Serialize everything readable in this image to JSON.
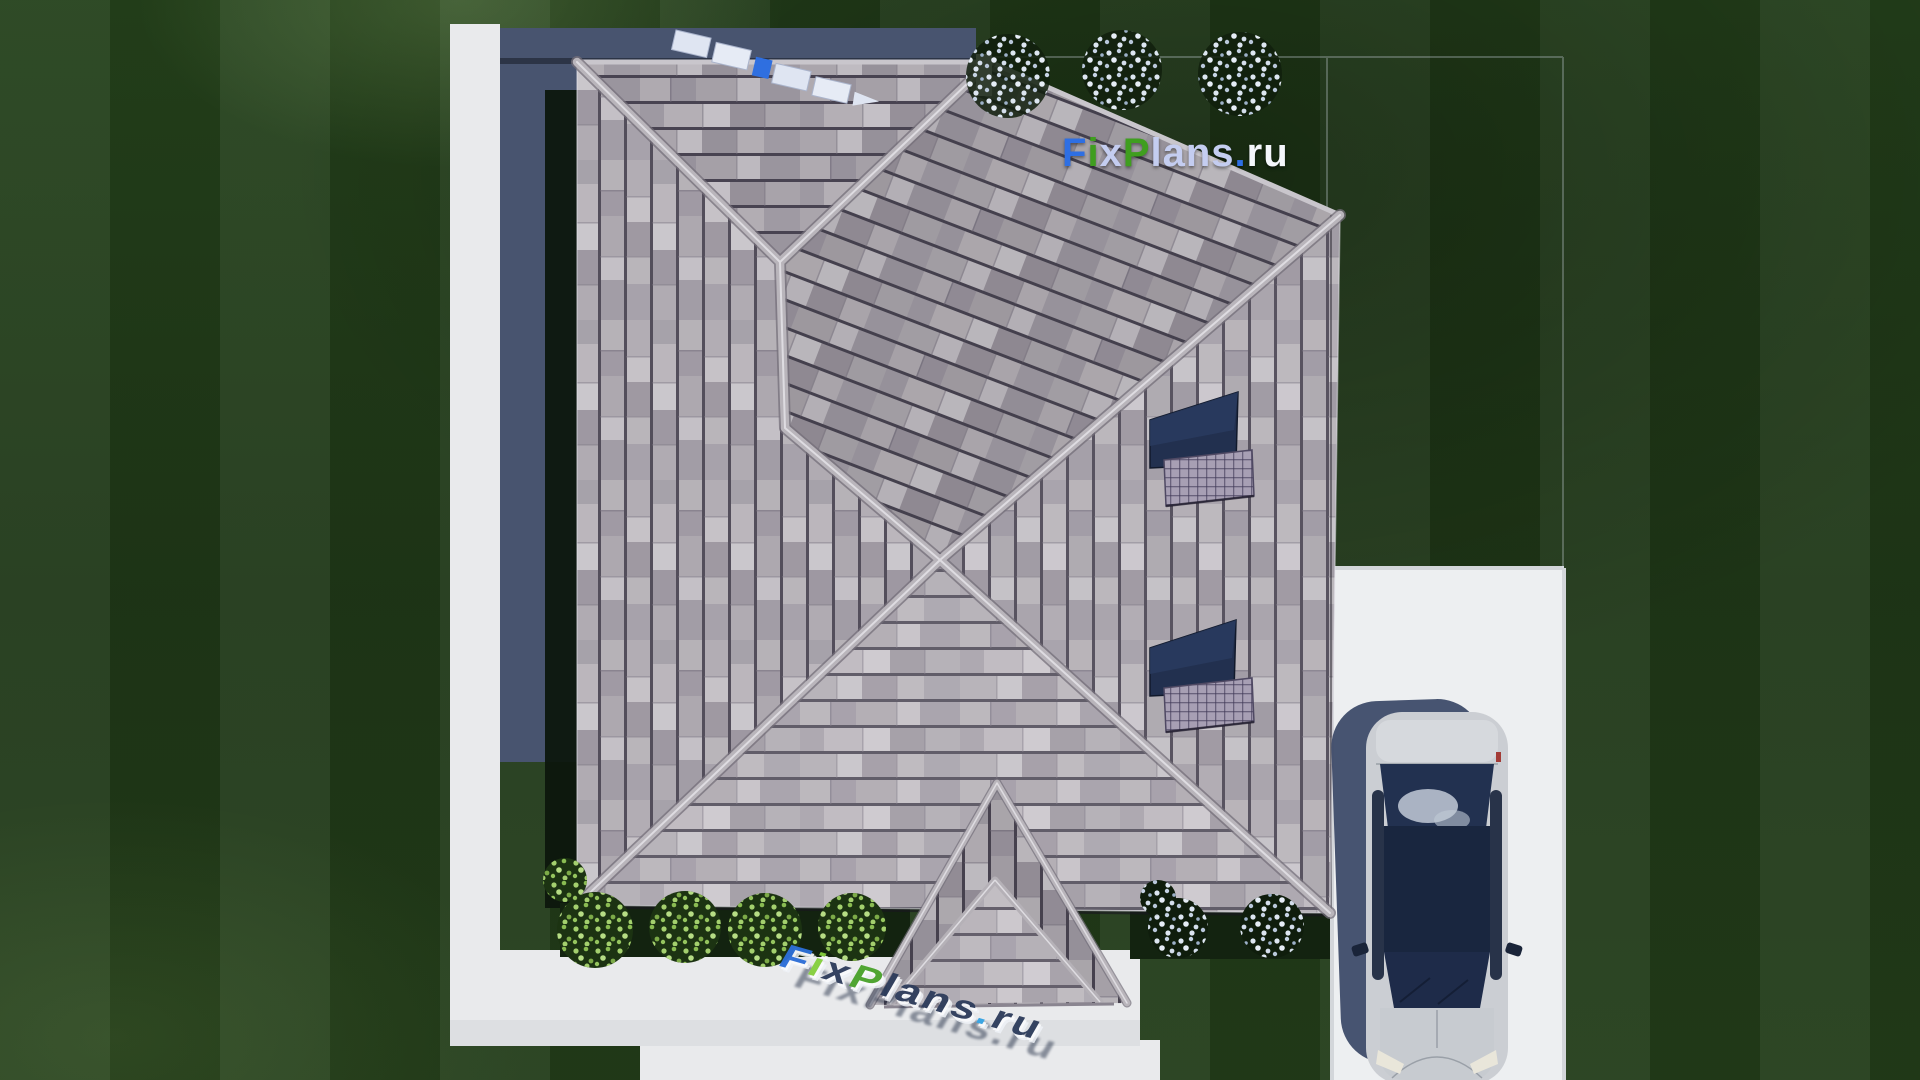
{
  "watermark": {
    "f": "F",
    "i": "i",
    "x": "x",
    "p": "P",
    "lans": "lans",
    "dot": ".",
    "ru": "ru",
    "full_text": "FixPlans.ru"
  },
  "colors": {
    "blue": "#2e6fe3",
    "green": "#3f9e1f",
    "lavender": "#c4cdf0",
    "white": "#f5f7fc",
    "blue3d": "#2d6fd8",
    "lime3d": "#86cf3f",
    "green3d": "#4aa32c",
    "sky3d": "#36a3e3",
    "navy3d": "#2e3d5c",
    "grass": "#223c19",
    "paving": "#e9eaec",
    "shadow": "#48546f",
    "roofBase": "#a7a2a9",
    "ridge": "#b9b5bb",
    "glass": "#22304f"
  }
}
